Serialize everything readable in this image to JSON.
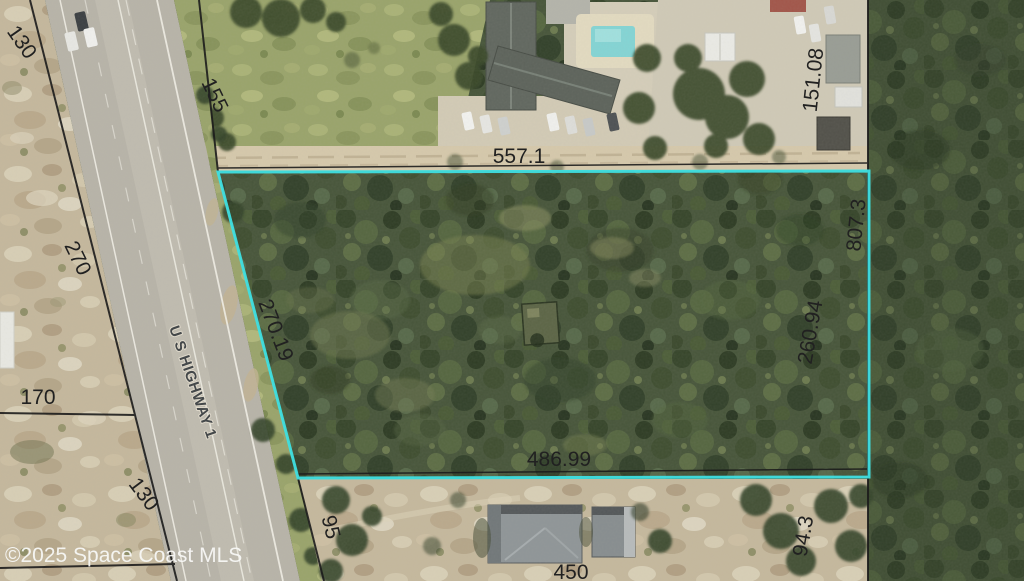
{
  "watermark": "©2025 Space Coast MLS",
  "road": {
    "label": "U S HIGHWAY 1"
  },
  "measurements": {
    "top_left_130": "130",
    "top_155": "155",
    "left_270": "270",
    "left_170": "170",
    "bottom_left_130": "130",
    "bottom_95": "95",
    "north_557_1": "557.1",
    "northeast_151_08": "151.08",
    "east_807_3": "807.3",
    "west_270_19": "270.19",
    "east_260_94": "260.94",
    "south_486_99": "486.99",
    "south_450": "450",
    "southeast_94_3": "94.3"
  },
  "colors": {
    "parcel_highlight": "#3fdfe2",
    "survey_line": "#1c1c1c",
    "label_text": "#212121",
    "watermark": "#f7f7f5"
  }
}
